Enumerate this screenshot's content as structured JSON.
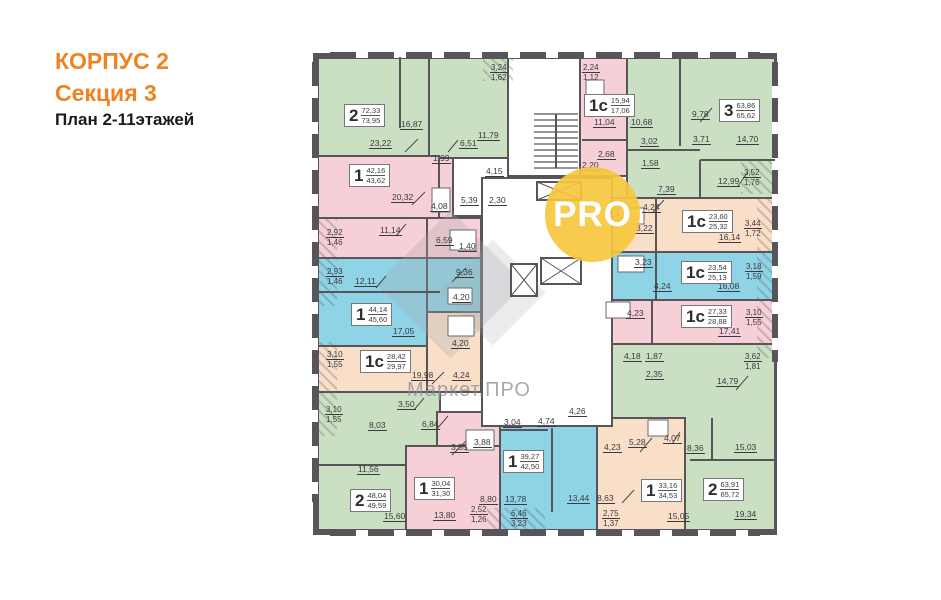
{
  "title": {
    "line1": "КОРПУС 2",
    "line2": "Секция 3",
    "line3": "План 2-11этажей"
  },
  "watermarks": {
    "badge": "PRO",
    "brand": "Маркет.ПРО"
  },
  "colors": {
    "accent_orange": "#f08222",
    "wall": "#57555a",
    "green": "#cbdfc2",
    "pink": "#f7cfd6",
    "blue": "#8ed3e6",
    "peach": "#f9dfc8",
    "badge_yellow": "#f6c73e"
  },
  "units": [
    {
      "t": "2",
      "a": "72,33",
      "b": "73,95",
      "x": 344,
      "y": 104
    },
    {
      "t": "1",
      "a": "42,16",
      "b": "43,62",
      "x": 349,
      "y": 164
    },
    {
      "t": "1",
      "a": "44,14",
      "b": "45,60",
      "x": 351,
      "y": 303
    },
    {
      "t": "1с",
      "a": "28,42",
      "b": "29,97",
      "x": 360,
      "y": 350
    },
    {
      "t": "2",
      "a": "48,04",
      "b": "49,59",
      "x": 350,
      "y": 489
    },
    {
      "t": "1",
      "a": "30,04",
      "b": "31,30",
      "x": 414,
      "y": 477
    },
    {
      "t": "1",
      "a": "39,27",
      "b": "42,50",
      "x": 503,
      "y": 450
    },
    {
      "t": "1",
      "a": "33,16",
      "b": "34,53",
      "x": 641,
      "y": 479
    },
    {
      "t": "2",
      "a": "63,91",
      "b": "65,72",
      "x": 703,
      "y": 478
    },
    {
      "t": "1с",
      "a": "15,94",
      "b": "17,06",
      "x": 584,
      "y": 94
    },
    {
      "t": "3",
      "a": "63,86",
      "b": "65,62",
      "x": 719,
      "y": 99
    },
    {
      "t": "1с",
      "a": "23,60",
      "b": "25,32",
      "x": 682,
      "y": 210
    },
    {
      "t": "1с",
      "a": "23,54",
      "b": "25,13",
      "x": 681,
      "y": 261
    },
    {
      "t": "1с",
      "a": "27,33",
      "b": "28,88",
      "x": 681,
      "y": 305
    }
  ],
  "dims": [
    {
      "t": "16,87",
      "x": 400,
      "y": 119
    },
    {
      "t": "23,22",
      "x": 369,
      "y": 138
    },
    {
      "t": "6,51",
      "x": 459,
      "y": 138
    },
    {
      "t": "11,79",
      "x": 477,
      "y": 130
    },
    {
      "t": "1,99",
      "x": 432,
      "y": 153
    },
    {
      "t": "4,15",
      "x": 485,
      "y": 166
    },
    {
      "t": "5,39",
      "x": 460,
      "y": 195
    },
    {
      "t": "2,30",
      "x": 488,
      "y": 195
    },
    {
      "t": "20,32",
      "x": 391,
      "y": 192
    },
    {
      "t": "4,08",
      "x": 430,
      "y": 201
    },
    {
      "t": "11,14",
      "x": 379,
      "y": 225
    },
    {
      "t": "6,59",
      "x": 435,
      "y": 235
    },
    {
      "t": "1,40",
      "x": 458,
      "y": 241
    },
    {
      "t": "12,11",
      "x": 354,
      "y": 276
    },
    {
      "t": "9,36",
      "x": 455,
      "y": 267
    },
    {
      "t": "4,20",
      "x": 452,
      "y": 292
    },
    {
      "t": "17,05",
      "x": 392,
      "y": 326
    },
    {
      "t": "4,20",
      "x": 451,
      "y": 338
    },
    {
      "t": "19,98",
      "x": 411,
      "y": 370
    },
    {
      "t": "4,24",
      "x": 452,
      "y": 370
    },
    {
      "t": "3,50",
      "x": 397,
      "y": 399
    },
    {
      "t": "8,03",
      "x": 368,
      "y": 420
    },
    {
      "t": "6,84",
      "x": 421,
      "y": 419
    },
    {
      "t": "11,56",
      "x": 357,
      "y": 464
    },
    {
      "t": "15,60",
      "x": 383,
      "y": 511
    },
    {
      "t": "3,55",
      "x": 450,
      "y": 442
    },
    {
      "t": "3,88",
      "x": 473,
      "y": 437
    },
    {
      "t": "8,80",
      "x": 479,
      "y": 494
    },
    {
      "t": "13,80",
      "x": 433,
      "y": 510
    },
    {
      "t": "3,04",
      "x": 503,
      "y": 417
    },
    {
      "t": "4,74",
      "x": 537,
      "y": 416
    },
    {
      "t": "4,26",
      "x": 568,
      "y": 406
    },
    {
      "t": "13,78",
      "x": 504,
      "y": 494
    },
    {
      "t": "13,44",
      "x": 567,
      "y": 493
    },
    {
      "t": "4,23",
      "x": 603,
      "y": 442
    },
    {
      "t": "5,28",
      "x": 628,
      "y": 437
    },
    {
      "t": "8,63",
      "x": 596,
      "y": 493
    },
    {
      "t": "15,05",
      "x": 667,
      "y": 511
    },
    {
      "t": "4,07",
      "x": 663,
      "y": 433
    },
    {
      "t": "8,36",
      "x": 686,
      "y": 443
    },
    {
      "t": "15,03",
      "x": 734,
      "y": 442
    },
    {
      "t": "19,34",
      "x": 734,
      "y": 509
    },
    {
      "t": "14,79",
      "x": 716,
      "y": 376
    },
    {
      "t": "2,35",
      "x": 645,
      "y": 369
    },
    {
      "t": "4,18",
      "x": 623,
      "y": 351
    },
    {
      "t": "1,87",
      "x": 645,
      "y": 351
    },
    {
      "t": "4,23",
      "x": 626,
      "y": 308
    },
    {
      "t": "17,41",
      "x": 718,
      "y": 326
    },
    {
      "t": "4,24",
      "x": 653,
      "y": 281
    },
    {
      "t": "16,08",
      "x": 717,
      "y": 281
    },
    {
      "t": "3,23",
      "x": 634,
      "y": 257
    },
    {
      "t": "4,24",
      "x": 642,
      "y": 202
    },
    {
      "t": "16,14",
      "x": 718,
      "y": 232
    },
    {
      "t": "3,22",
      "x": 635,
      "y": 223
    },
    {
      "t": "11,04",
      "x": 593,
      "y": 117
    },
    {
      "t": "2,68",
      "x": 597,
      "y": 149
    },
    {
      "t": "2,20",
      "x": 581,
      "y": 160
    },
    {
      "t": "10,68",
      "x": 630,
      "y": 117
    },
    {
      "t": "9,78",
      "x": 691,
      "y": 109
    },
    {
      "t": "3,02",
      "x": 640,
      "y": 136
    },
    {
      "t": "3,71",
      "x": 692,
      "y": 134
    },
    {
      "t": "14,70",
      "x": 736,
      "y": 134
    },
    {
      "t": "1,58",
      "x": 641,
      "y": 158
    },
    {
      "t": "12,99",
      "x": 717,
      "y": 176
    },
    {
      "t": "7,39",
      "x": 657,
      "y": 184
    }
  ],
  "dims2": [
    {
      "a": "3,24",
      "b": "1,62",
      "x": 490,
      "y": 63
    },
    {
      "a": "2,24",
      "b": "1,12",
      "x": 582,
      "y": 63
    },
    {
      "a": "3,52",
      "b": "1,76",
      "x": 743,
      "y": 168
    },
    {
      "a": "3,44",
      "b": "1,72",
      "x": 744,
      "y": 219
    },
    {
      "a": "3,18",
      "b": "1,59",
      "x": 745,
      "y": 262
    },
    {
      "a": "3,10",
      "b": "1,55",
      "x": 745,
      "y": 308
    },
    {
      "a": "3,62",
      "b": "1,81",
      "x": 744,
      "y": 352
    },
    {
      "a": "2,92",
      "b": "1,46",
      "x": 326,
      "y": 228
    },
    {
      "a": "2,93",
      "b": "1,46",
      "x": 326,
      "y": 267
    },
    {
      "a": "3,10",
      "b": "1,55",
      "x": 326,
      "y": 350
    },
    {
      "a": "3,10",
      "b": "1,55",
      "x": 325,
      "y": 405
    },
    {
      "a": "2,52",
      "b": "1,26",
      "x": 470,
      "y": 505
    },
    {
      "a": "6,46",
      "b": "3,23",
      "x": 510,
      "y": 509
    },
    {
      "a": "2,75",
      "b": "1,37",
      "x": 602,
      "y": 509
    }
  ]
}
